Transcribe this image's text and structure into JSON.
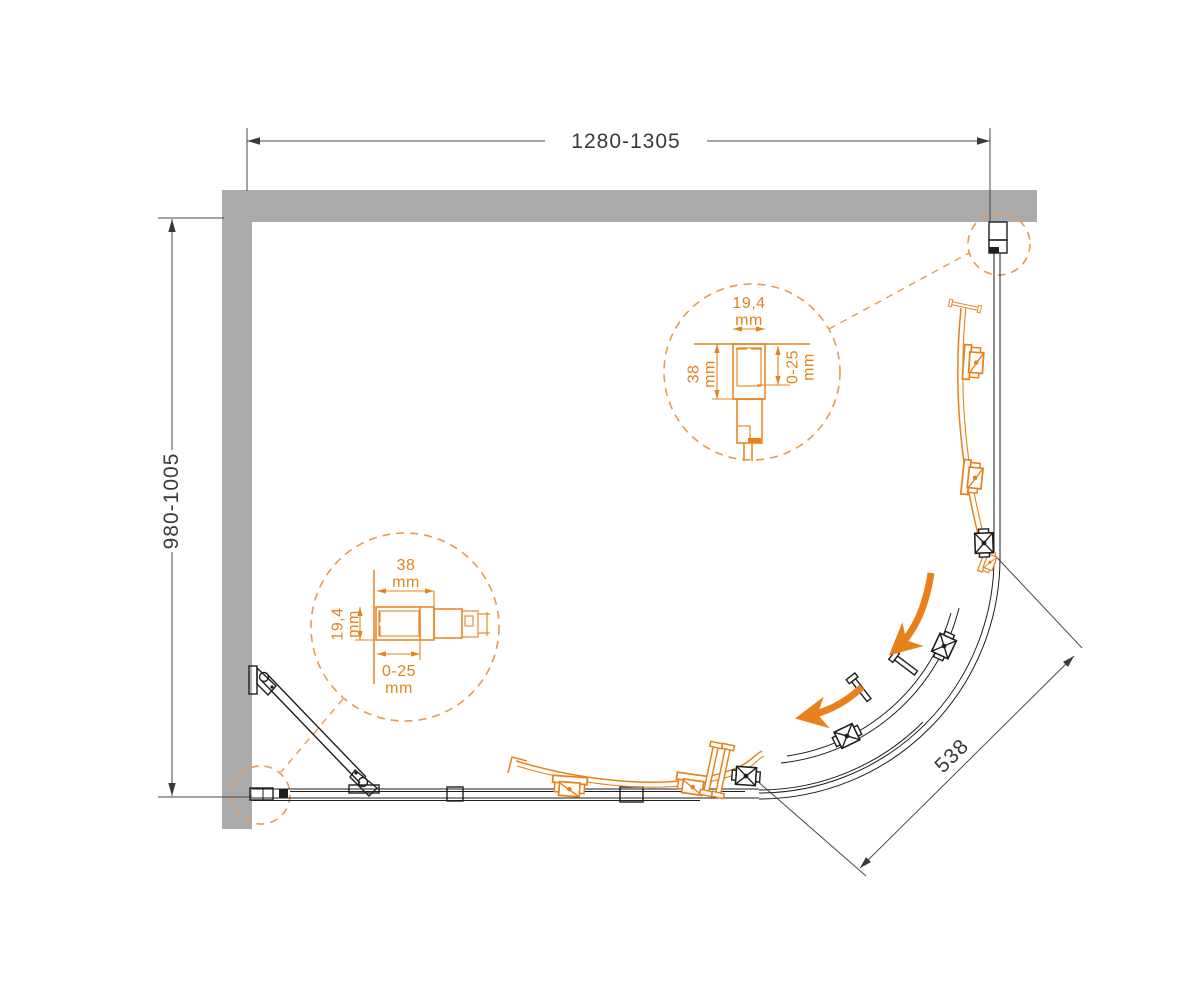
{
  "diagram": {
    "kind": "shower-enclosure-installation-top-view"
  },
  "dims": {
    "width": "1280-1305",
    "depth": "980-1005",
    "opening": "538"
  },
  "detail_top": {
    "top_value": "19,4",
    "top_unit": "mm",
    "side_value": "38",
    "side_unit": "mm",
    "range_value": "0-25",
    "range_unit": "mm"
  },
  "detail_bottom": {
    "top_value": "38",
    "top_unit": "mm",
    "side_value": "19,4",
    "side_unit": "mm",
    "range_value": "0-25",
    "range_unit": "mm"
  },
  "colors": {
    "accent_orange": "#e8811c",
    "callout_orange": "#e99a4e",
    "wall_gray": "#ababab",
    "line_black": "#1e1e1e",
    "dimension_gray": "#3a3a3a"
  }
}
